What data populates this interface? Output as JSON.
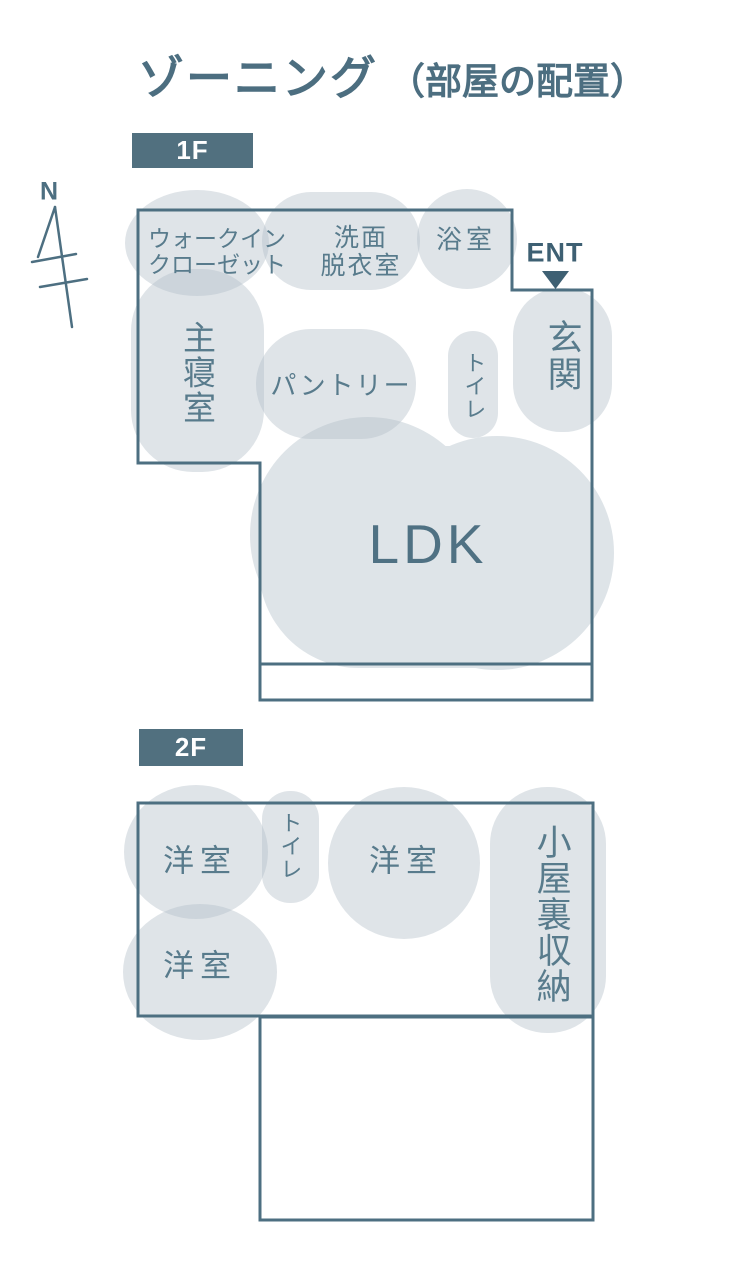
{
  "title": {
    "main": "ゾーニング",
    "sub": "（部屋の配置）"
  },
  "compass": {
    "north_label": "N"
  },
  "colors": {
    "accent": "#4d6f81",
    "badge_background": "#51707f",
    "room_blob_fill": "#b2bfc9",
    "room_label_text": "#587b8c",
    "entrance_marker_text": "#3e6073"
  },
  "floor1": {
    "badge": "1F",
    "entrance_marker": "ENT",
    "rooms": {
      "walk_in_closet": {
        "line1": "ウォークイン",
        "line2": "クローゼット"
      },
      "washroom": {
        "line1": "洗面",
        "line2": "脱衣室"
      },
      "bathroom": {
        "label": "浴室"
      },
      "master_bedroom": {
        "label": "主寝室"
      },
      "pantry": {
        "label": "パントリー"
      },
      "toilet": {
        "label": "トイレ"
      },
      "entrance_hall": {
        "label": "玄関"
      },
      "ldk": {
        "label": "LDK"
      }
    }
  },
  "floor2": {
    "badge": "2F",
    "rooms": {
      "western_room_1": {
        "label": "洋室"
      },
      "toilet": {
        "label": "トイレ"
      },
      "western_room_2": {
        "label": "洋室"
      },
      "western_room_3": {
        "label": "洋室"
      },
      "attic_storage": {
        "label": "小屋裏収納"
      }
    }
  }
}
